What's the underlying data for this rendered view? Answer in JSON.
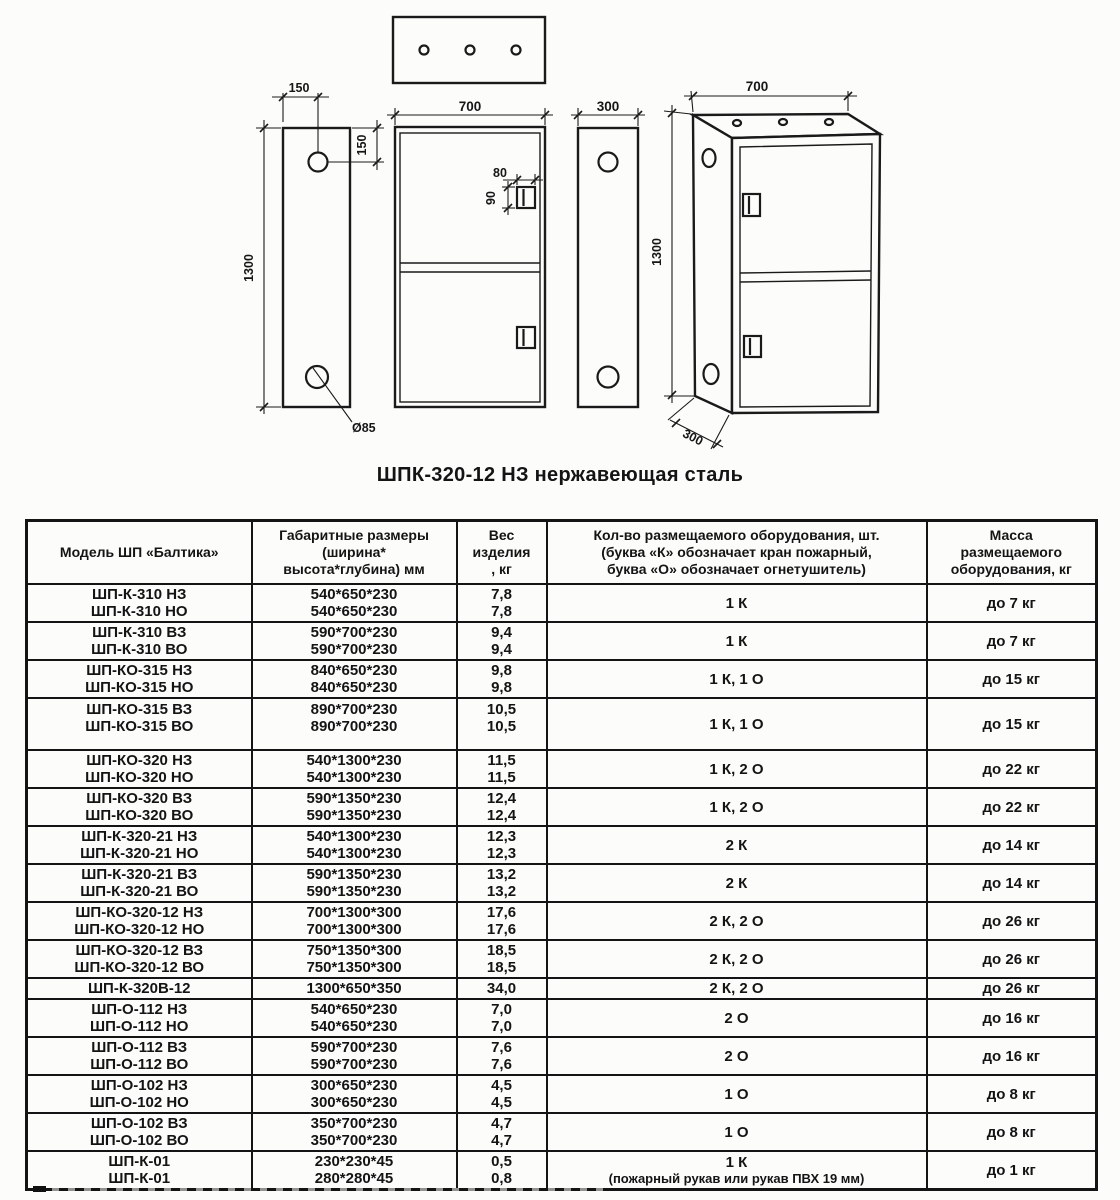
{
  "drawing": {
    "caption": "ШПК-320-12 НЗ нержавеющая сталь",
    "left_view": {
      "dim_width": "150",
      "dim_hole_offset": "150",
      "dim_height": "1300",
      "dim_hole_diameter": "Ø85"
    },
    "front_view": {
      "dim_width": "700",
      "dim_handle_width": "80",
      "dim_handle_height": "90"
    },
    "side_view": {
      "dim_depth": "300"
    },
    "iso_view": {
      "dim_width": "700",
      "dim_height": "1300",
      "dim_depth": "300"
    }
  },
  "table": {
    "headers": [
      "Модель ШП «Балтика»",
      "Габаритные размеры\n(ширина*\nвысота*глубина) мм",
      "Вес\nизделия\n, кг",
      "Кол-во размещаемого оборудования, шт.\n(буква «К» обозначает кран пожарный,\nбуква «О» обозначает огнетушитель)",
      "Масса\nразмещаемого\nоборудования, кг"
    ],
    "rows": [
      {
        "models": [
          "ШП-К-310 НЗ",
          "ШП-К-310 НО"
        ],
        "sizes": [
          "540*650*230",
          "540*650*230"
        ],
        "weights": [
          "7,8",
          "7,8"
        ],
        "equipment": "1 К",
        "mass": "до 7 кг"
      },
      {
        "models": [
          "ШП-К-310 ВЗ",
          "ШП-К-310 ВО"
        ],
        "sizes": [
          "590*700*230",
          "590*700*230"
        ],
        "weights": [
          "9,4",
          "9,4"
        ],
        "equipment": "1 К",
        "mass": "до 7 кг"
      },
      {
        "models": [
          "ШП-КО-315 НЗ",
          "ШП-КО-315 НО"
        ],
        "sizes": [
          "840*650*230",
          "840*650*230"
        ],
        "weights": [
          "9,8",
          "9,8"
        ],
        "equipment": "1 К, 1 О",
        "mass": "до 15 кг"
      },
      {
        "models": [
          "ШП-КО-315 ВЗ",
          "ШП-КО-315 ВО"
        ],
        "sizes": [
          "890*700*230",
          "890*700*230"
        ],
        "weights": [
          "10,5",
          "10,5"
        ],
        "equipment": "1 К, 1 О",
        "mass": "до 15 кг",
        "tall": true
      },
      {
        "models": [
          "ШП-КО-320 НЗ",
          "ШП-КО-320 НО"
        ],
        "sizes": [
          "540*1300*230",
          "540*1300*230"
        ],
        "weights": [
          "11,5",
          "11,5"
        ],
        "equipment": "1 К, 2 О",
        "mass": "до 22 кг"
      },
      {
        "models": [
          "ШП-КО-320 ВЗ",
          "ШП-КО-320 ВО"
        ],
        "sizes": [
          "590*1350*230",
          "590*1350*230"
        ],
        "weights": [
          "12,4",
          "12,4"
        ],
        "equipment": "1 К, 2 О",
        "mass": "до 22 кг"
      },
      {
        "models": [
          "ШП-К-320-21 НЗ",
          "ШП-К-320-21 НО"
        ],
        "sizes": [
          "540*1300*230",
          "540*1300*230"
        ],
        "weights": [
          "12,3",
          "12,3"
        ],
        "equipment": "2 К",
        "mass": "до 14 кг"
      },
      {
        "models": [
          "ШП-К-320-21 ВЗ",
          "ШП-К-320-21 ВО"
        ],
        "sizes": [
          "590*1350*230",
          "590*1350*230"
        ],
        "weights": [
          "13,2",
          "13,2"
        ],
        "equipment": "2 К",
        "mass": "до 14 кг"
      },
      {
        "models": [
          "ШП-КО-320-12 НЗ",
          "ШП-КО-320-12 НО"
        ],
        "sizes": [
          "700*1300*300",
          "700*1300*300"
        ],
        "weights": [
          "17,6",
          "17,6"
        ],
        "equipment": "2 К, 2 О",
        "mass": "до 26 кг"
      },
      {
        "models": [
          "ШП-КО-320-12 ВЗ",
          "ШП-КО-320-12 ВО"
        ],
        "sizes": [
          "750*1350*300",
          "750*1350*300"
        ],
        "weights": [
          "18,5",
          "18,5"
        ],
        "equipment": "2 К, 2 О",
        "mass": "до 26 кг"
      },
      {
        "models": [
          "ШП-К-320В-12"
        ],
        "sizes": [
          "1300*650*350"
        ],
        "weights": [
          "34,0"
        ],
        "equipment": "2 К, 2 О",
        "mass": "до 26 кг"
      },
      {
        "models": [
          "ШП-О-112 НЗ",
          "ШП-О-112 НО"
        ],
        "sizes": [
          "540*650*230",
          "540*650*230"
        ],
        "weights": [
          "7,0",
          "7,0"
        ],
        "equipment": "2 О",
        "mass": "до 16 кг"
      },
      {
        "models": [
          "ШП-О-112 ВЗ",
          "ШП-О-112 ВО"
        ],
        "sizes": [
          "590*700*230",
          "590*700*230"
        ],
        "weights": [
          "7,6",
          "7,6"
        ],
        "equipment": "2 О",
        "mass": "до 16 кг"
      },
      {
        "models": [
          "ШП-О-102 НЗ",
          "ШП-О-102 НО"
        ],
        "sizes": [
          "300*650*230",
          "300*650*230"
        ],
        "weights": [
          "4,5",
          "4,5"
        ],
        "equipment": "1 О",
        "mass": "до 8 кг"
      },
      {
        "models": [
          "ШП-О-102 ВЗ",
          "ШП-О-102 ВО"
        ],
        "sizes": [
          "350*700*230",
          "350*700*230"
        ],
        "weights": [
          "4,7",
          "4,7"
        ],
        "equipment": "1 О",
        "mass": "до 8 кг"
      },
      {
        "models": [
          "ШП-К-01",
          "ШП-К-01"
        ],
        "sizes": [
          "230*230*45",
          "280*280*45"
        ],
        "weights": [
          "0,5",
          "0,8"
        ],
        "equipment": "1 К",
        "equipment_note": "(пожарный рукав или рукав ПВХ 19 мм)",
        "mass": "до 1 кг"
      }
    ]
  }
}
